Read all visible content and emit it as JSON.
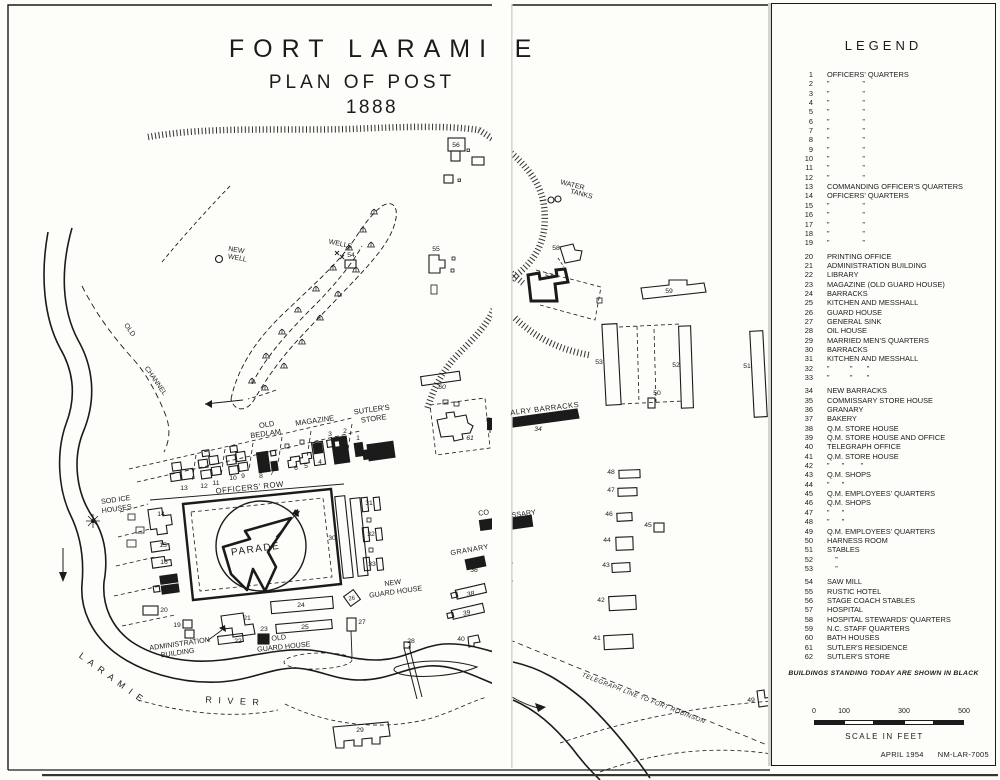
{
  "colors": {
    "ink": "#1b1b1b",
    "paper": "#fdfdf9"
  },
  "title": {
    "main": "FORT LARAMI",
    "main_cut": "E",
    "sub": "PLAN OF POST",
    "year": "1888"
  },
  "legend": {
    "heading": "LEGEND",
    "note": "BUILDINGS STANDING TODAY ARE SHOWN IN BLACK",
    "items": [
      {
        "n": "1",
        "t": "OFFICERS' QUARTERS"
      },
      {
        "n": "2",
        "t": "”                ”"
      },
      {
        "n": "3",
        "t": "”                ”"
      },
      {
        "n": "4",
        "t": "”                ”"
      },
      {
        "n": "5",
        "t": "”                ”"
      },
      {
        "n": "6",
        "t": "”                ”"
      },
      {
        "n": "7",
        "t": "”                ”"
      },
      {
        "n": "8",
        "t": "”                ”"
      },
      {
        "n": "9",
        "t": "”                ”"
      },
      {
        "n": "10",
        "t": "”                ”"
      },
      {
        "n": "11",
        "t": "”                ”"
      },
      {
        "n": "12",
        "t": "”                ”"
      },
      {
        "n": "13",
        "t": "COMMANDING OFFICER'S QUARTERS"
      },
      {
        "n": "14",
        "t": "OFFICERS' QUARTERS"
      },
      {
        "n": "15",
        "t": "”                ”"
      },
      {
        "n": "16",
        "t": "”                ”"
      },
      {
        "n": "17",
        "t": "”                ”"
      },
      {
        "n": "18",
        "t": "”                ”"
      },
      {
        "n": "19",
        "t": "”                ”"
      },
      {
        "n": "20",
        "t": "PRINTING OFFICE",
        "g": 1
      },
      {
        "n": "21",
        "t": "ADMINISTRATION BUILDING"
      },
      {
        "n": "22",
        "t": "LIBRARY"
      },
      {
        "n": "23",
        "t": "MAGAZINE (OLD GUARD HOUSE)"
      },
      {
        "n": "24",
        "t": "BARRACKS"
      },
      {
        "n": "25",
        "t": "KITCHEN AND MESSHALL"
      },
      {
        "n": "26",
        "t": "GUARD HOUSE"
      },
      {
        "n": "27",
        "t": "GENERAL SINK"
      },
      {
        "n": "28",
        "t": "OIL HOUSE"
      },
      {
        "n": "29",
        "t": "MARRIED MEN'S QUARTERS"
      },
      {
        "n": "30",
        "t": "BARRACKS"
      },
      {
        "n": "31",
        "t": "KITCHEN AND MESSHALL"
      },
      {
        "n": "32",
        "t": "”          ”       ”"
      },
      {
        "n": "33",
        "t": "”          ”       ”"
      },
      {
        "n": "34",
        "t": "NEW BARRACKS",
        "g": 1
      },
      {
        "n": "35",
        "t": "COMMISSARY STORE HOUSE"
      },
      {
        "n": "36",
        "t": "GRANARY"
      },
      {
        "n": "37",
        "t": "BAKERY"
      },
      {
        "n": "38",
        "t": "Q.M. STORE HOUSE"
      },
      {
        "n": "39",
        "t": "Q.M. STORE HOUSE AND OFFICE"
      },
      {
        "n": "40",
        "t": "TELEGRAPH OFFICE"
      },
      {
        "n": "41",
        "t": "Q.M. STORE HOUSE"
      },
      {
        "n": "42",
        "t": "”      ”        ”"
      },
      {
        "n": "43",
        "t": "Q.M. SHOPS"
      },
      {
        "n": "44",
        "t": "”      ”"
      },
      {
        "n": "45",
        "t": "Q.M. EMPLOYEES' QUARTERS"
      },
      {
        "n": "46",
        "t": "Q.M. SHOPS"
      },
      {
        "n": "47",
        "t": "”      ”"
      },
      {
        "n": "48",
        "t": "”      ”"
      },
      {
        "n": "49",
        "t": "Q.M. EMPLOYEES' QUARTERS"
      },
      {
        "n": "50",
        "t": "HARNESS ROOM"
      },
      {
        "n": "51",
        "t": "STABLES"
      },
      {
        "n": "52",
        "t": "    ”"
      },
      {
        "n": "53",
        "t": "    ”"
      },
      {
        "n": "54",
        "t": "SAW MILL",
        "g": 1
      },
      {
        "n": "55",
        "t": "RUSTIC HOTEL"
      },
      {
        "n": "56",
        "t": "STAGE COACH STABLES"
      },
      {
        "n": "57",
        "t": "HOSPITAL"
      },
      {
        "n": "58",
        "t": "HOSPITAL STEWARDS' QUARTERS"
      },
      {
        "n": "59",
        "t": "N.C. STAFF QUARTERS"
      },
      {
        "n": "60",
        "t": "BATH HOUSES"
      },
      {
        "n": "61",
        "t": "SUTLER'S RESIDENCE"
      },
      {
        "n": "62",
        "t": "SUTLER'S STORE"
      }
    ]
  },
  "scale": {
    "ticks": [
      "0",
      "100",
      "300",
      "500"
    ],
    "caption": "SCALE IN FEET"
  },
  "stamp": {
    "date": "APRIL 1954",
    "code": "NM-LAR-7005"
  },
  "map": {
    "texts": [
      {
        "id": "old-bedlam-1",
        "t": "OLD",
        "x": 267,
        "y": 427,
        "r": -8,
        "s": 7.5
      },
      {
        "id": "old-bedlam-2",
        "t": "BEDLAM",
        "x": 266,
        "y": 436,
        "r": -8,
        "s": 7.5
      },
      {
        "id": "magazine-label",
        "t": "MAGAZINE",
        "x": 315,
        "y": 423,
        "r": -8,
        "s": 7.5
      },
      {
        "id": "sutlers-store-1",
        "t": "SUTLER'S",
        "x": 372,
        "y": 412,
        "r": -8,
        "s": 7.5
      },
      {
        "id": "sutlers-store-2",
        "t": "STORE",
        "x": 374,
        "y": 421,
        "r": -8,
        "s": 7.5
      },
      {
        "id": "officers-row",
        "t": "OFFICERS' ROW",
        "x": 250,
        "y": 490,
        "r": -6,
        "s": 7.8,
        "ls": 0.5
      },
      {
        "id": "parade",
        "t": "PARADE",
        "x": 256,
        "y": 552,
        "r": -8,
        "s": 10,
        "ls": 1.5
      },
      {
        "id": "north-n",
        "t": "N",
        "x": 295,
        "y": 516,
        "r": 15,
        "s": 9,
        "i": 1,
        "w": 1
      },
      {
        "id": "sod-ice-1",
        "t": "SOD ICE",
        "x": 116,
        "y": 502,
        "r": -8,
        "s": 7.2
      },
      {
        "id": "sod-ice-2",
        "t": "HOUSES",
        "x": 117,
        "y": 511,
        "r": -8,
        "s": 7.2
      },
      {
        "id": "admin-1",
        "t": "ADMINISTRATION",
        "x": 180,
        "y": 646,
        "r": -8,
        "s": 7.2
      },
      {
        "id": "admin-2",
        "t": "BUILDING",
        "x": 178,
        "y": 655,
        "r": -8,
        "s": 7.2
      },
      {
        "id": "old-guard-1",
        "t": "OLD",
        "x": 279,
        "y": 640,
        "r": -6,
        "s": 7.2
      },
      {
        "id": "old-guard-2",
        "t": "GUARD HOUSE",
        "x": 284,
        "y": 649,
        "r": -6,
        "s": 7.2
      },
      {
        "id": "new-guard-1",
        "t": "NEW",
        "x": 393,
        "y": 585,
        "r": -8,
        "s": 7.2
      },
      {
        "id": "new-guard-2",
        "t": "GUARD HOUSE",
        "x": 396,
        "y": 594,
        "r": -8,
        "s": 7.2
      },
      {
        "id": "granary-label",
        "t": "GRANARY",
        "x": 470,
        "y": 552,
        "r": -10,
        "s": 7.2,
        "ls": 0.5
      },
      {
        "id": "commissary-left",
        "t": "CO",
        "x": 484,
        "y": 515,
        "r": -8,
        "s": 7.2
      },
      {
        "id": "commissary-right",
        "t": "SSARY",
        "x": 524,
        "y": 516,
        "r": -8,
        "s": 7.2
      },
      {
        "id": "cavalry-barracks",
        "t": "ALRY BARRACKS",
        "x": 545,
        "y": 411,
        "r": -7,
        "s": 7.5,
        "ls": 0.5
      },
      {
        "id": "water-tanks-1",
        "t": "WATER",
        "x": 572,
        "y": 187,
        "r": 14,
        "s": 7
      },
      {
        "id": "water-tanks-2",
        "t": "TANKS",
        "x": 581,
        "y": 196,
        "r": 14,
        "s": 7
      },
      {
        "id": "wells",
        "t": "WELLS",
        "x": 340,
        "y": 246,
        "r": 12,
        "s": 7
      },
      {
        "id": "new-well-1",
        "t": "NEW",
        "x": 236,
        "y": 252,
        "r": 10,
        "s": 7
      },
      {
        "id": "new-well-2",
        "t": "WELL",
        "x": 237,
        "y": 260,
        "r": 10,
        "s": 7
      },
      {
        "id": "old-channel-1",
        "t": "OLD",
        "x": 128,
        "y": 331,
        "r": 55,
        "s": 7
      },
      {
        "id": "old-channel-2",
        "t": "CHANNEL",
        "x": 154,
        "y": 382,
        "r": 55,
        "s": 7
      },
      {
        "id": "laramie",
        "t": "L A R A M I E",
        "x": 110,
        "y": 680,
        "r": 36,
        "s": 9,
        "ls": 2
      },
      {
        "id": "river",
        "t": "R I V E R",
        "x": 233,
        "y": 704,
        "r": 3,
        "s": 9,
        "ls": 2
      },
      {
        "id": "telegraph",
        "t": "TELEGRAPH LINE TO FORT ROBINSON",
        "x": 643,
        "y": 700,
        "r": 21,
        "s": 6.2,
        "i": 1,
        "ls": 0.5
      },
      {
        "id": "num-1",
        "t": "1",
        "x": 358,
        "y": 440
      },
      {
        "id": "num-2",
        "t": "2",
        "x": 345,
        "y": 433
      },
      {
        "id": "num-3",
        "t": "3",
        "x": 330,
        "y": 436
      },
      {
        "id": "num-4",
        "t": "4",
        "x": 320,
        "y": 464
      },
      {
        "id": "num-5",
        "t": "5",
        "x": 306,
        "y": 468
      },
      {
        "id": "num-6",
        "t": "6",
        "x": 296,
        "y": 470
      },
      {
        "id": "num-7",
        "t": "7",
        "x": 272,
        "y": 475
      },
      {
        "id": "num-8",
        "t": "8",
        "x": 261,
        "y": 478
      },
      {
        "id": "num-9",
        "t": "9",
        "x": 243,
        "y": 478
      },
      {
        "id": "num-10",
        "t": "10",
        "x": 233,
        "y": 480
      },
      {
        "id": "num-11",
        "t": "11",
        "x": 216,
        "y": 485
      },
      {
        "id": "num-12",
        "t": "12",
        "x": 204,
        "y": 488
      },
      {
        "id": "num-13",
        "t": "13",
        "x": 184,
        "y": 490
      },
      {
        "id": "num-14",
        "t": "14",
        "x": 161,
        "y": 516
      },
      {
        "id": "num-15",
        "t": "15",
        "x": 163,
        "y": 547
      },
      {
        "id": "num-16",
        "t": "16",
        "x": 164,
        "y": 564
      },
      {
        "id": "num-17",
        "t": "17",
        "x": 170,
        "y": 583,
        "c": "w",
        "s": 6
      },
      {
        "id": "num-18",
        "t": "18",
        "x": 170,
        "y": 591,
        "c": "w",
        "s": 6
      },
      {
        "id": "num-19",
        "t": "19",
        "x": 177,
        "y": 627
      },
      {
        "id": "num-20",
        "t": "20",
        "x": 164,
        "y": 612
      },
      {
        "id": "num-21",
        "t": "21",
        "x": 247,
        "y": 620
      },
      {
        "id": "num-22",
        "t": "22",
        "x": 238,
        "y": 643
      },
      {
        "id": "num-23",
        "t": "23",
        "x": 264,
        "y": 631
      },
      {
        "id": "num-24",
        "t": "24",
        "x": 301,
        "y": 607
      },
      {
        "id": "num-25",
        "t": "25",
        "x": 305,
        "y": 629
      },
      {
        "id": "num-26",
        "t": "26",
        "x": 352,
        "y": 600,
        "r": -8,
        "s": 6
      },
      {
        "id": "num-27",
        "t": "27",
        "x": 362,
        "y": 624
      },
      {
        "id": "num-28",
        "t": "28",
        "x": 411,
        "y": 643
      },
      {
        "id": "num-29",
        "t": "29",
        "x": 360,
        "y": 732
      },
      {
        "id": "num-30",
        "t": "30",
        "x": 332,
        "y": 540
      },
      {
        "id": "num-31",
        "t": "31",
        "x": 369,
        "y": 505
      },
      {
        "id": "num-32",
        "t": "32",
        "x": 371,
        "y": 536
      },
      {
        "id": "num-33",
        "t": "33",
        "x": 372,
        "y": 566
      },
      {
        "id": "num-34",
        "t": "34",
        "x": 538,
        "y": 431,
        "i": 1
      },
      {
        "id": "num-36",
        "t": "36",
        "x": 474,
        "y": 572,
        "i": 1
      },
      {
        "id": "num-38",
        "t": "38",
        "x": 471,
        "y": 596,
        "i": 1,
        "r": -12
      },
      {
        "id": "num-39",
        "t": "39",
        "x": 467,
        "y": 615,
        "i": 1,
        "r": -12
      },
      {
        "id": "num-40",
        "t": "40",
        "x": 461,
        "y": 641
      },
      {
        "id": "num-41",
        "t": "41",
        "x": 597,
        "y": 640
      },
      {
        "id": "num-42",
        "t": "42",
        "x": 601,
        "y": 602
      },
      {
        "id": "num-43",
        "t": "43",
        "x": 606,
        "y": 567
      },
      {
        "id": "num-44",
        "t": "44",
        "x": 607,
        "y": 542
      },
      {
        "id": "num-45",
        "t": "45",
        "x": 648,
        "y": 527
      },
      {
        "id": "num-46",
        "t": "46",
        "x": 609,
        "y": 516
      },
      {
        "id": "num-47",
        "t": "47",
        "x": 611,
        "y": 492
      },
      {
        "id": "num-48",
        "t": "48",
        "x": 611,
        "y": 474
      },
      {
        "id": "num-49",
        "t": "49",
        "x": 751,
        "y": 702
      },
      {
        "id": "num-50",
        "t": "50",
        "x": 657,
        "y": 395
      },
      {
        "id": "num-51",
        "t": "51",
        "x": 747,
        "y": 368
      },
      {
        "id": "num-52",
        "t": "52",
        "x": 676,
        "y": 367
      },
      {
        "id": "num-53",
        "t": "53",
        "x": 599,
        "y": 364
      },
      {
        "id": "num-54",
        "t": "54",
        "x": 351,
        "y": 257
      },
      {
        "id": "num-55",
        "t": "55",
        "x": 436,
        "y": 251
      },
      {
        "id": "num-56",
        "t": "56",
        "x": 456,
        "y": 147
      },
      {
        "id": "num-57",
        "t": "57",
        "x": 549,
        "y": 278
      },
      {
        "id": "num-58",
        "t": "58",
        "x": 556,
        "y": 250
      },
      {
        "id": "num-59",
        "t": "59",
        "x": 669,
        "y": 293
      },
      {
        "id": "num-60",
        "t": "60",
        "x": 442,
        "y": 389,
        "i": 1
      },
      {
        "id": "num-61",
        "t": "61",
        "x": 470,
        "y": 440,
        "i": 1
      }
    ]
  }
}
